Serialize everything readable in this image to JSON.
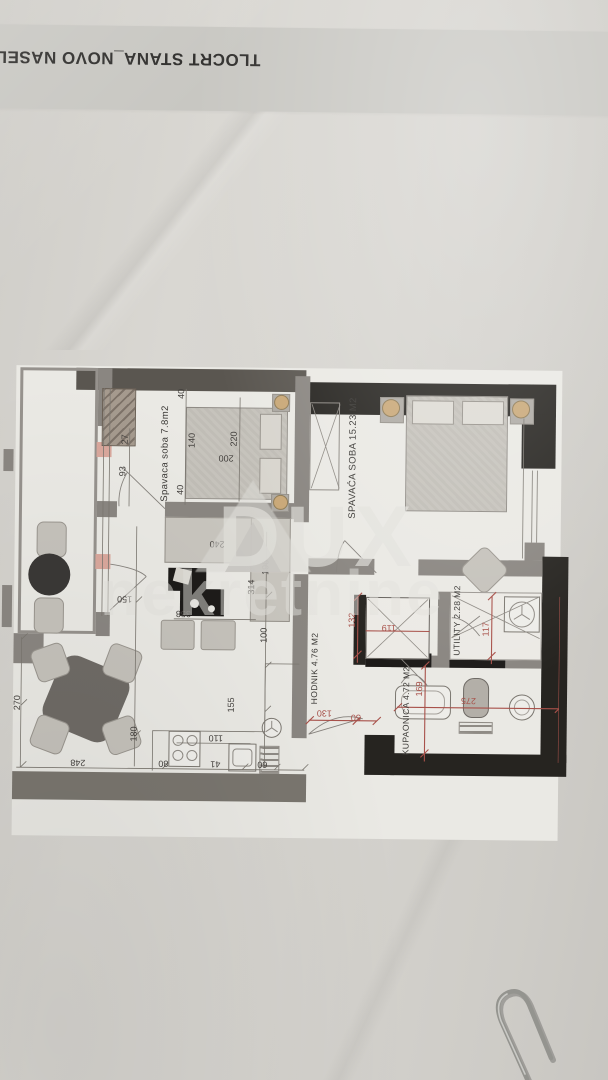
{
  "photo": {
    "header_title": "TLOCRT STANA_NOVO NASEL"
  },
  "watermark": {
    "brand": "DUX",
    "subtitle": "nekretnine"
  },
  "plan": {
    "rooms": {
      "bedroom1": "Spavaca soba 7.8m2",
      "bedroom2": "SPAVAĆA SOBA 15.23 M2",
      "hallway": "HODNIK 4.76 M2",
      "bathroom": "KUPAONICA 4.72 M2",
      "utility": "UTILITY 2.28 M2"
    },
    "dims": {
      "balcony_len": "270",
      "living_w": "248",
      "entry_clear": "93",
      "door_off": "27",
      "bed1_gap_top": "40",
      "bed1_gap_bot": "40",
      "bed1_w": "140",
      "bed1_len": "220",
      "mattress": "200",
      "sofa": "240",
      "sofa_side": "196",
      "tv_wall": "358",
      "living_len": "314",
      "kitchen_gap": "100",
      "chairs": "150",
      "counter_h": "155",
      "counter_w": "110",
      "island": "180",
      "run": "80",
      "sink": "41",
      "end": "60"
    },
    "dims_red": {
      "shaft_h": "132",
      "shaft_w": "119",
      "utility_w": "117",
      "bath_h": "169",
      "bath_w": "275",
      "entry_w": "130",
      "entry_side": "50"
    },
    "colors": {
      "paper": "#d6d4cf",
      "band": "#c8c7c2",
      "plan_paper": "#eae9e4",
      "wall": "#8a8681",
      "wall_dark": "#262420",
      "dim_red": "#a8514a",
      "window_marker": "#d9a79c",
      "lamp": "#c9a878"
    }
  }
}
